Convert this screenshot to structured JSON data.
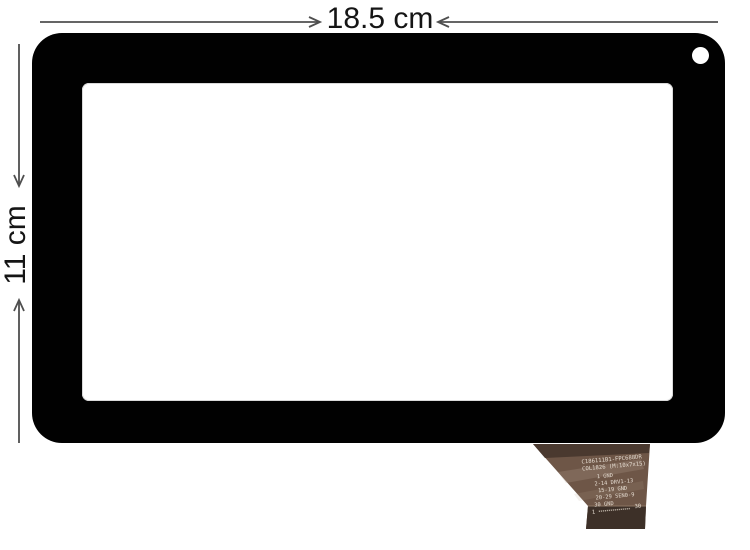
{
  "page": {
    "background": "#ffffff"
  },
  "annotations": {
    "width_label": "18.5 cm",
    "height_label": "11 cm",
    "arrow_color": "#4f4f4f",
    "label_color": "#151515"
  },
  "device": {
    "bezel_color": "#010101",
    "screen_color": "#ffffff",
    "camera_hole_color": "#ffffff"
  },
  "flex_cable": {
    "body_color": "#6e5647",
    "top_strip_color": "#4a392f",
    "connector_band_color": "#3d3028",
    "band_edge_color": "#8d7663",
    "print_color": "#e6ddd2",
    "label_lines": [
      "C186111B1-FPC688DR",
      "COL1826 (M:10x7x15)",
      "1 GND",
      "2-14 DRV1-13",
      "15-19 GND",
      "20-29 SEN0-9",
      "30 GND"
    ],
    "pin_first": "1",
    "pin_last": "30"
  }
}
